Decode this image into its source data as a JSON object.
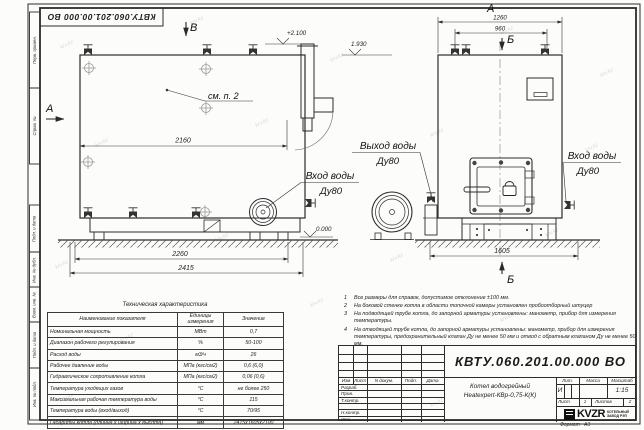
{
  "watermark": "krv.kz",
  "margin": {
    "labels": [
      "Перв. примен.",
      "Справ. №",
      "Подп. и дата",
      "Инв. № дубл.",
      "Взам. инв. №",
      "Подп. и дата",
      "Инв. № подл."
    ]
  },
  "drawing": {
    "side_view": {
      "marker_top": "В",
      "marker_left": "А",
      "see_note": "см. п. 2",
      "elev_chimney": "+2.100",
      "elev_top": "1.930",
      "elev_zero": "0.000",
      "dim_body": "2160",
      "dim_base": "2260",
      "dim_overall": "2415",
      "inlet_label": "Вход воды",
      "inlet_size": "Ду80"
    },
    "front_view": {
      "view_label": "А",
      "marker_top": "Б",
      "marker_bottom": "Б",
      "dim_overall": "1260",
      "dim_valves": "960",
      "dim_base": "1605",
      "outlet_label": "Выход воды",
      "outlet_size": "Ду80",
      "inlet_label": "Вход воды",
      "inlet_size": "Ду80"
    }
  },
  "tech_table": {
    "title": "Техническая характеристика",
    "headers": [
      "Наименование показателя",
      "Единицы измерения",
      "Значение"
    ],
    "rows": [
      [
        "Номинальная мощность",
        "МВт",
        "0,7"
      ],
      [
        "Диапазон рабочего регулирования",
        "%",
        "50-100"
      ],
      [
        "Расход воды",
        "м3/ч",
        "26"
      ],
      [
        "Рабочее давление воды",
        "МПа (кгс/см2)",
        "0,6 (6,0)"
      ],
      [
        "Гидравлическое сопротивление котла",
        "МПа (кгс/см2)",
        "0,06 (0,6)"
      ],
      [
        "Температура уходящих газов",
        "°С",
        "не более 250"
      ],
      [
        "Максимальная рабочая температура воды",
        "°С",
        "115"
      ],
      [
        "Температура воды (вход/выход)",
        "°С",
        "70/95"
      ],
      [
        "Габариты котла (длинна х ширина х высота)",
        "мм",
        "2415х1605х2100"
      ]
    ]
  },
  "notes": [
    {
      "n": "1",
      "text": "Все размеры для справок, допустимое отклонение ±100 мм."
    },
    {
      "n": "2",
      "text": "На боковой стенке котла в области топочной камеры установлен пробоотборный штуцер"
    },
    {
      "n": "3",
      "text": "На подводящей трубе котла, до запорной арматуры установлены: манометр, прибор для измерения температуры."
    },
    {
      "n": "4",
      "text": "На отводящей трубе котла, до запорной арматуры установлены: манометр, прибор для измерения температуры, предохранительный клапан Ду не менее 50 мм и отвод с обратным клапаном Ду не менее 50 мм."
    }
  ],
  "title_block": {
    "doc_number": "КВТУ.060.201.00.000  ВО",
    "columns": [
      "Изм",
      "Лист",
      "N докум.",
      "Подп.",
      "Дата"
    ],
    "row_labels": [
      "Разраб.",
      "Пров.",
      "Т.контр.",
      "Н.контр.",
      "Утв."
    ],
    "product_line1": "Котел водогрейный",
    "product_line2": "Heatexpert-КВр-0,75-К(К)",
    "lit_label": "Лит.",
    "mass_label": "Масса",
    "scale_label": "Масштаб",
    "lit_value": "И",
    "scale_value": "1:15",
    "sheet_label": "Лист",
    "sheet_value": "1",
    "sheets_label": "Листов",
    "sheets_value": "2",
    "logo_text": "KVZR",
    "logo_caption1": "КОТЕЛЬНЫЙ",
    "logo_caption2": "ЗАВОД РЭП",
    "format_label": "Формат",
    "format_value": "А3"
  }
}
